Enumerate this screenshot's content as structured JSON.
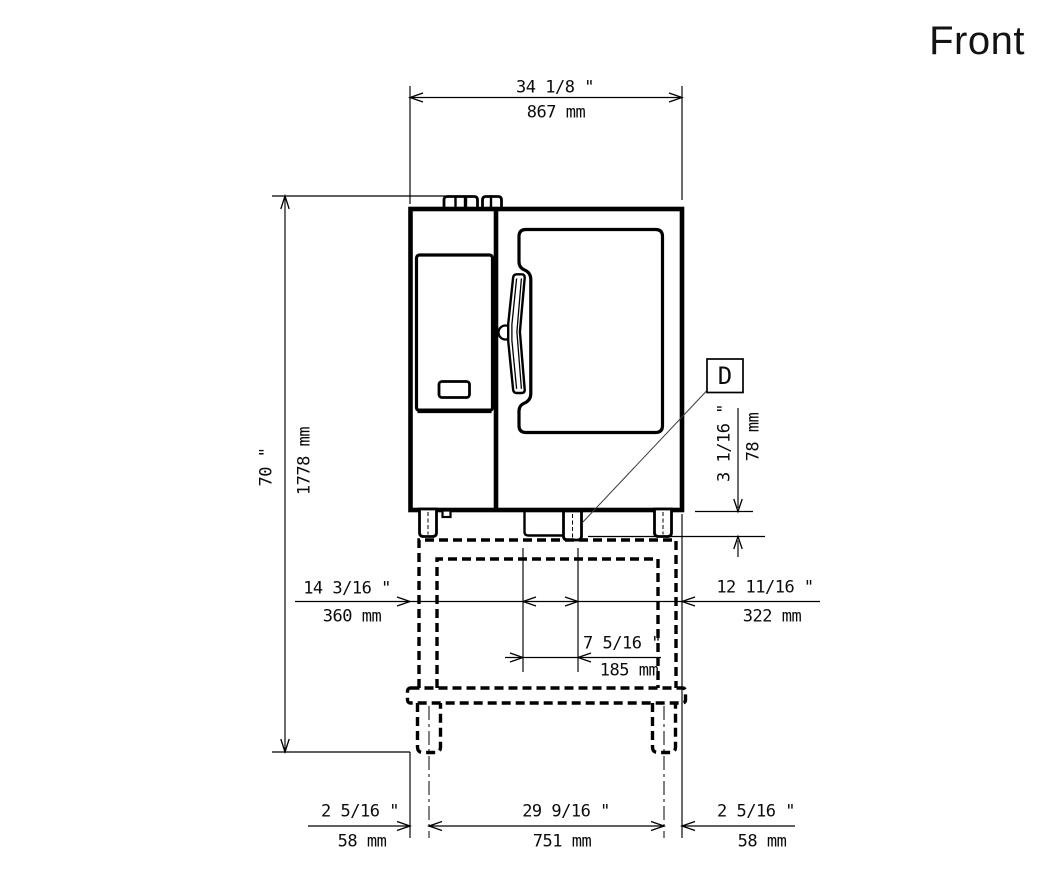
{
  "title": "Front",
  "detail_marker": "D",
  "dims": {
    "overall_width_in": "34 1/8 \"",
    "overall_width_mm": "867 mm",
    "overall_height_in": "70 \"",
    "overall_height_mm": "1778 mm",
    "foot_height_in": "3 1/16 \"",
    "foot_height_mm": "78 mm",
    "foot_left_offset_in": "14 3/16 \"",
    "foot_left_offset_mm": "360 mm",
    "foot_right_offset_in": "12 11/16 \"",
    "foot_right_offset_mm": "322 mm",
    "foot_center_width_in": "7 5/16 \"",
    "foot_center_width_mm": "185 mm",
    "leg_left_offset_in": "2 5/16 \"",
    "leg_left_offset_mm": "58 mm",
    "leg_spacing_in": "29 9/16 \"",
    "leg_spacing_mm": "751 mm",
    "leg_right_offset_in": "2 5/16 \"",
    "leg_right_offset_mm": "58 mm"
  },
  "colors": {
    "line": "#000000",
    "leader": "#3a3a3a",
    "background": "#ffffff"
  }
}
